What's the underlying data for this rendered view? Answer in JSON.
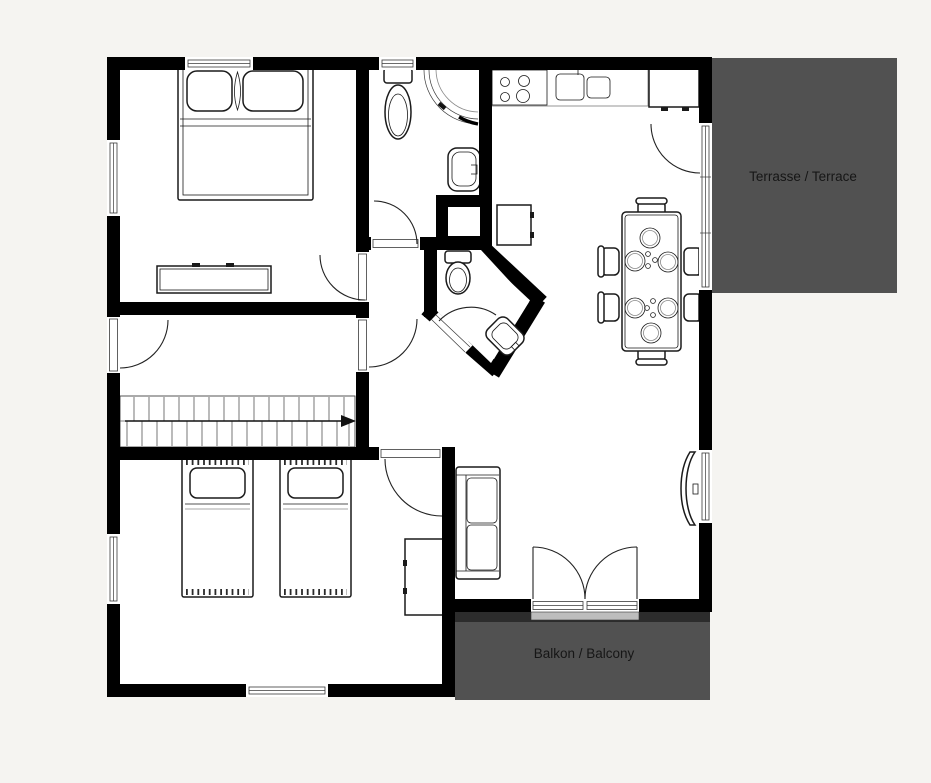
{
  "page": {
    "background": "#f5f4f1"
  },
  "colors": {
    "wall": "#000000",
    "floor": "#ffffff",
    "outdoor_fill": "#515151",
    "outdoor_edge": "#2c2c2c",
    "label_text": "#161616",
    "furniture_line": "#1a1a1a"
  },
  "areas": {
    "terrace": {
      "label": "Terrasse / Terrace"
    },
    "balcony": {
      "label": "Balkon / Balcony"
    }
  },
  "icons": [
    "double-bed",
    "single-bed",
    "dresser",
    "wardrobe",
    "sofa",
    "tv",
    "dining-table",
    "dining-chair",
    "plate",
    "stove",
    "kitchen-sink",
    "fridge",
    "kitchen-counter",
    "kitchen-cabinet",
    "toilet",
    "corner-shower",
    "washbasin",
    "stairs",
    "stairs-direction-arrow",
    "duct-shaft",
    "door-swing-arc",
    "window"
  ]
}
